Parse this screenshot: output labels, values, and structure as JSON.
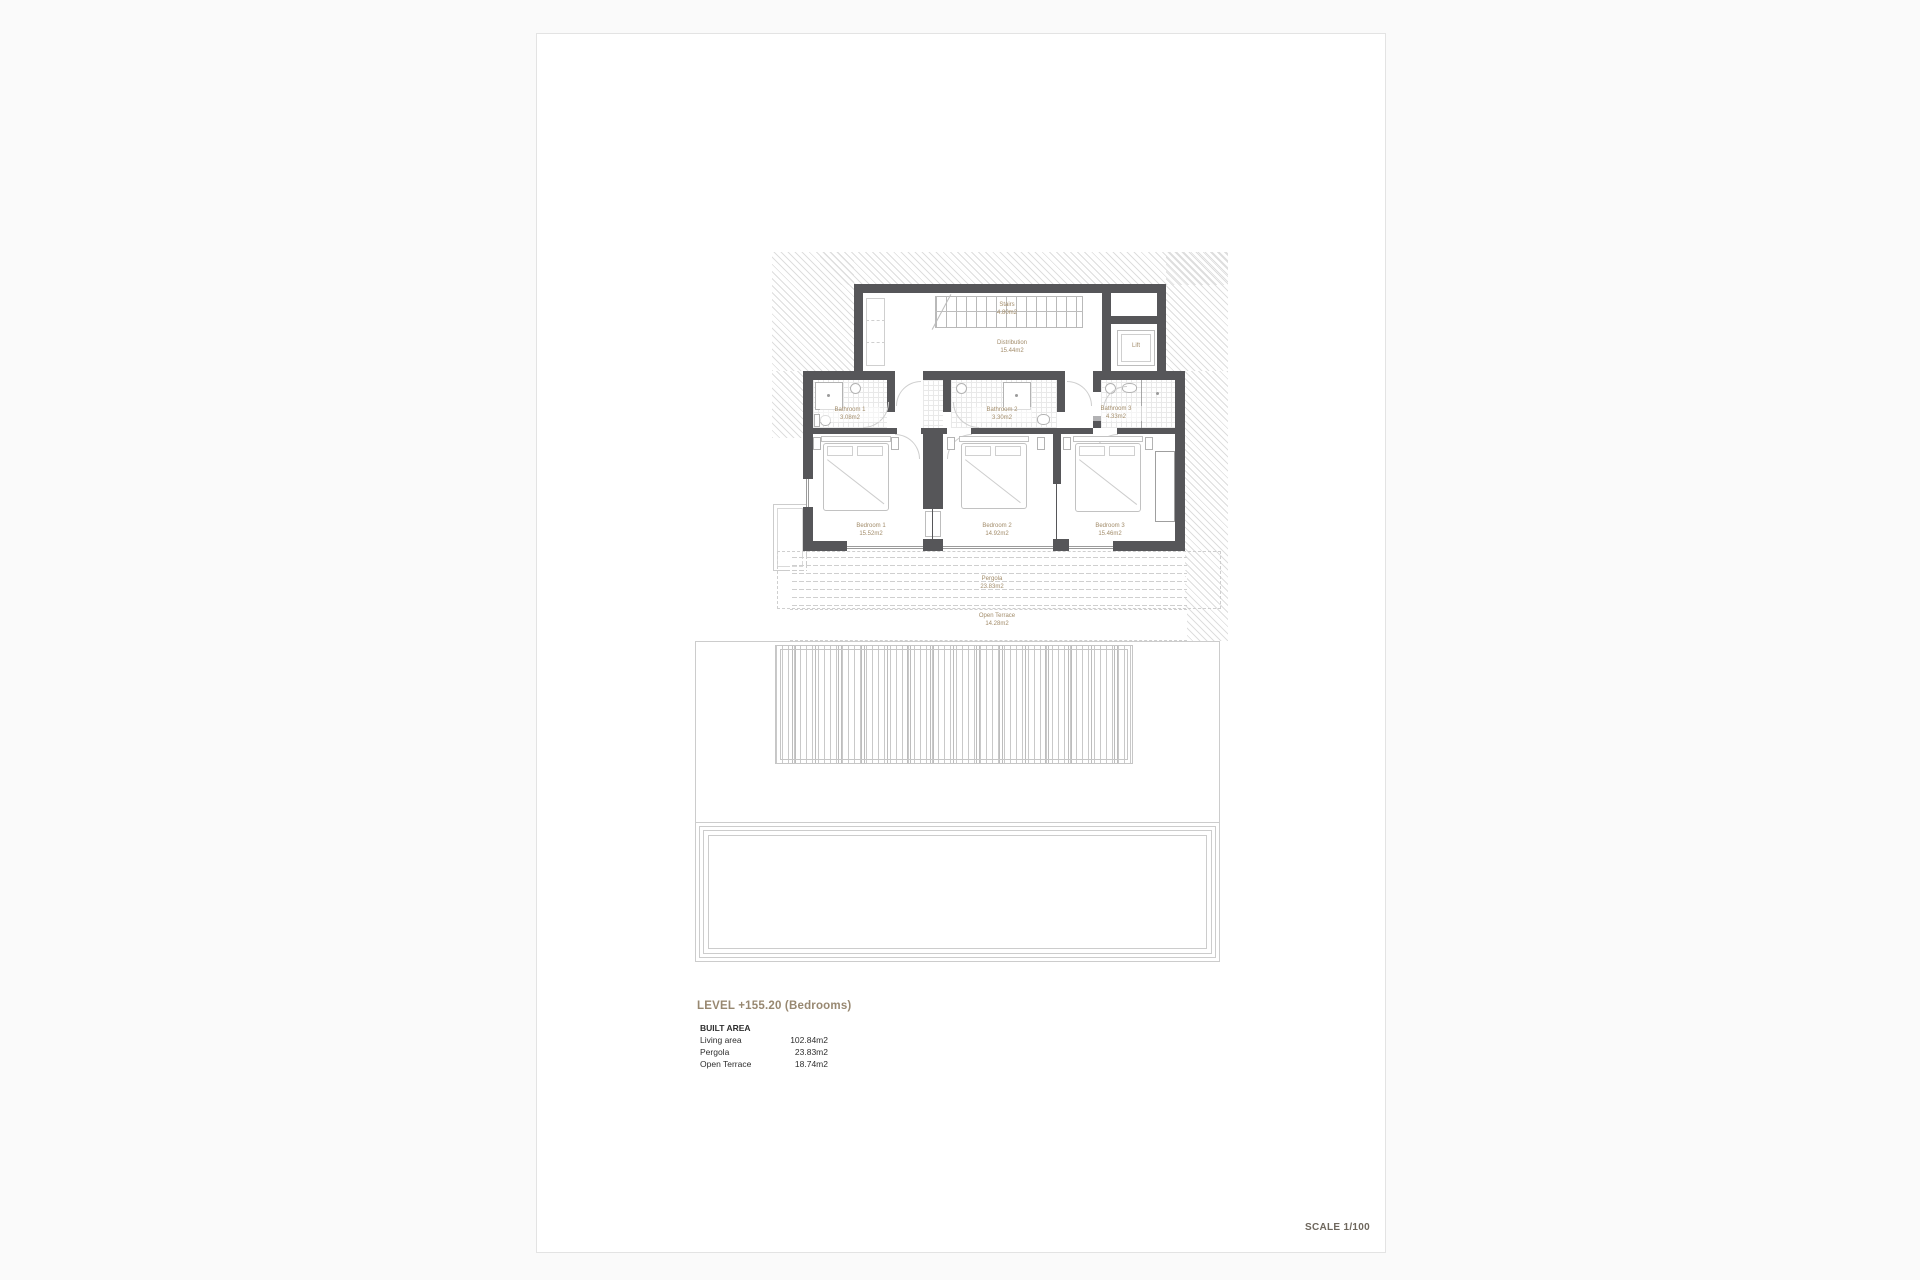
{
  "sheet": {
    "level_title": "LEVEL +155.20 (Bedrooms)",
    "scale_label": "SCALE 1/100",
    "built_area": {
      "title": "BUILT AREA",
      "rows": [
        {
          "label": "Living area",
          "value": "102.84m2"
        },
        {
          "label": "Pergola",
          "value": "23.83m2"
        },
        {
          "label": "Open Terrace",
          "value": "18.74m2"
        }
      ]
    }
  },
  "plan": {
    "rooms": {
      "stairs": {
        "name": "Stairs",
        "area": "4.80m2"
      },
      "distribution": {
        "name": "Distribution",
        "area": "15.44m2"
      },
      "lift": {
        "name": "Lift"
      },
      "bathroom1": {
        "name": "Bathroom 1",
        "area": "3.08m2"
      },
      "bathroom2": {
        "name": "Bathroom 2",
        "area": "3.30m2"
      },
      "bathroom3": {
        "name": "Bathroom 3",
        "area": "4.33m2"
      },
      "bedroom1": {
        "name": "Bedroom 1",
        "area": "15.52m2"
      },
      "bedroom2": {
        "name": "Bedroom 2",
        "area": "14.92m2"
      },
      "bedroom3": {
        "name": "Bedroom 3",
        "area": "15.46m2"
      },
      "pergola": {
        "name": "Pergola",
        "area": "23.83m2"
      },
      "open_terrace": {
        "name": "Open Terrace",
        "area": "14.28m2"
      }
    },
    "colors": {
      "wall": "#565659",
      "label": "#a28c6a",
      "line": "#c6c6c6",
      "hatch": "#dedede"
    }
  }
}
